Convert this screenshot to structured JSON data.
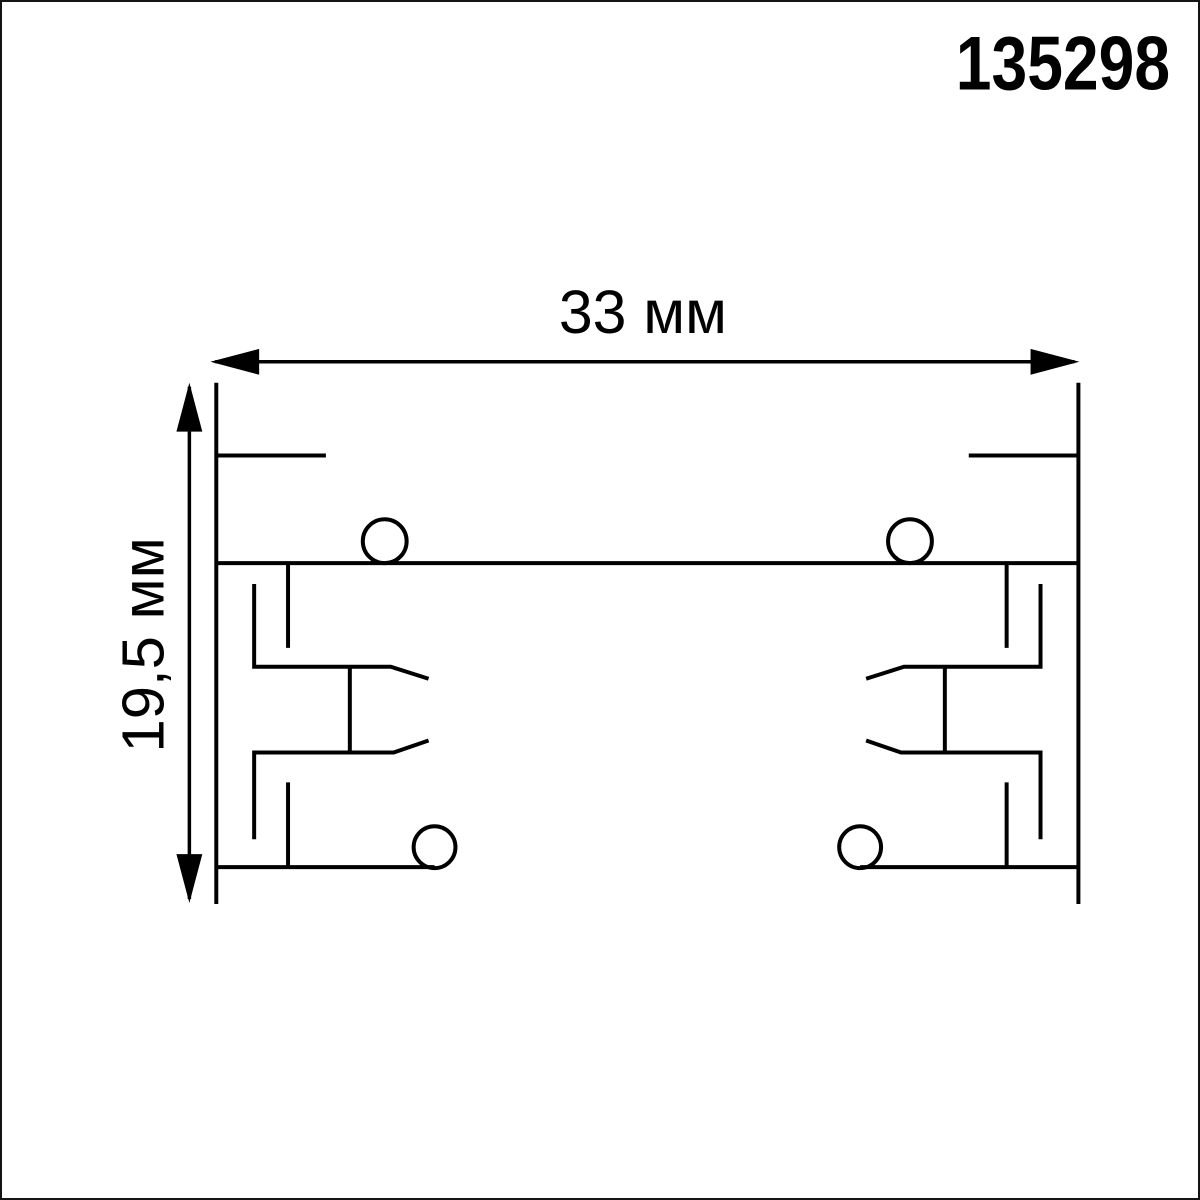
{
  "article_number": "135298",
  "dimensions": {
    "width_label": "33 мм",
    "height_label": "19,5 мм",
    "width_mm": 33,
    "height_mm": 19.5,
    "unit": "мм"
  },
  "colors": {
    "line": "#000000",
    "background": "#ffffff",
    "border": "#141414"
  }
}
